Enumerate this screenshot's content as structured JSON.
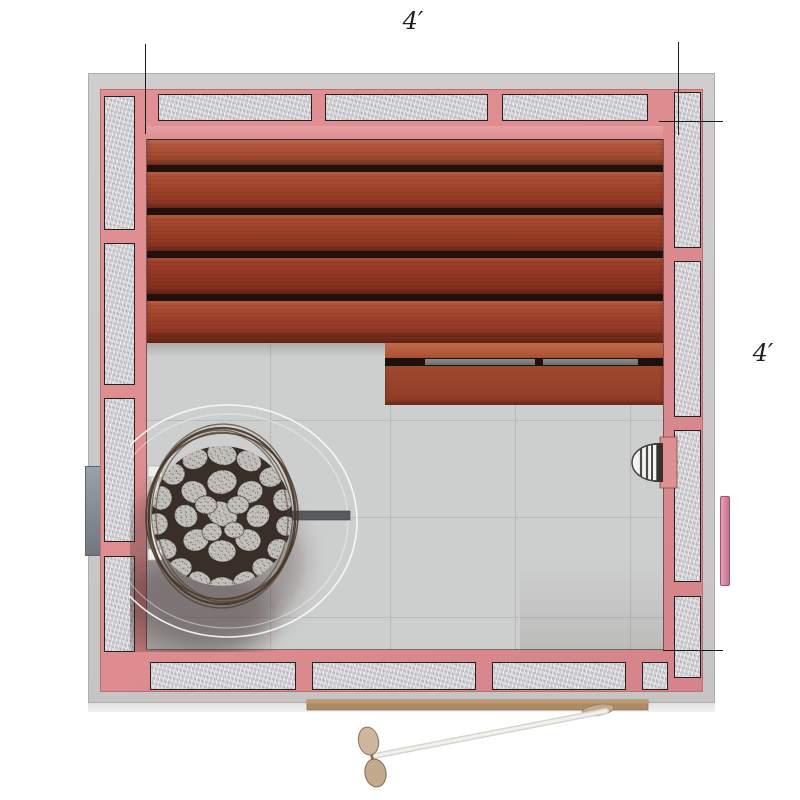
{
  "dimension_labels": {
    "top": "4′",
    "right": "4′"
  },
  "palette": {
    "background": "#ffffff",
    "framing_pink": "#dd8c8f",
    "sheathing_gray": "#cbcac8",
    "insulation_gray": "#d7d5d9",
    "bench_wood": "#9d3f28",
    "slat_gap_dark": "#23100a",
    "floor_tile_gray": "#cdcfce",
    "heater_stone_gray": "#c2c0bc",
    "basket_wire_brown": "#53402f",
    "rail_gray": "#787b7c",
    "door_glass": "#f3f1ee",
    "door_handle_tan": "#c9ac8f",
    "threshold_tan": "#ad8b66",
    "exterior_handle_pink": "#d98aa2",
    "dimension_line": "#1b1b1b"
  },
  "components": {
    "plan_type": "sauna-top-view-floor-plan",
    "walls": "insulated-stud-walls",
    "upper_bench": "wood-slat-bench",
    "lower_bench": "wood-step-bench",
    "heater": "rock-filled-heater-basket",
    "clearance": "heater-clearance-arc",
    "light": "wall-light-fixture",
    "door": "glass-door-open",
    "threshold": "door-threshold"
  }
}
